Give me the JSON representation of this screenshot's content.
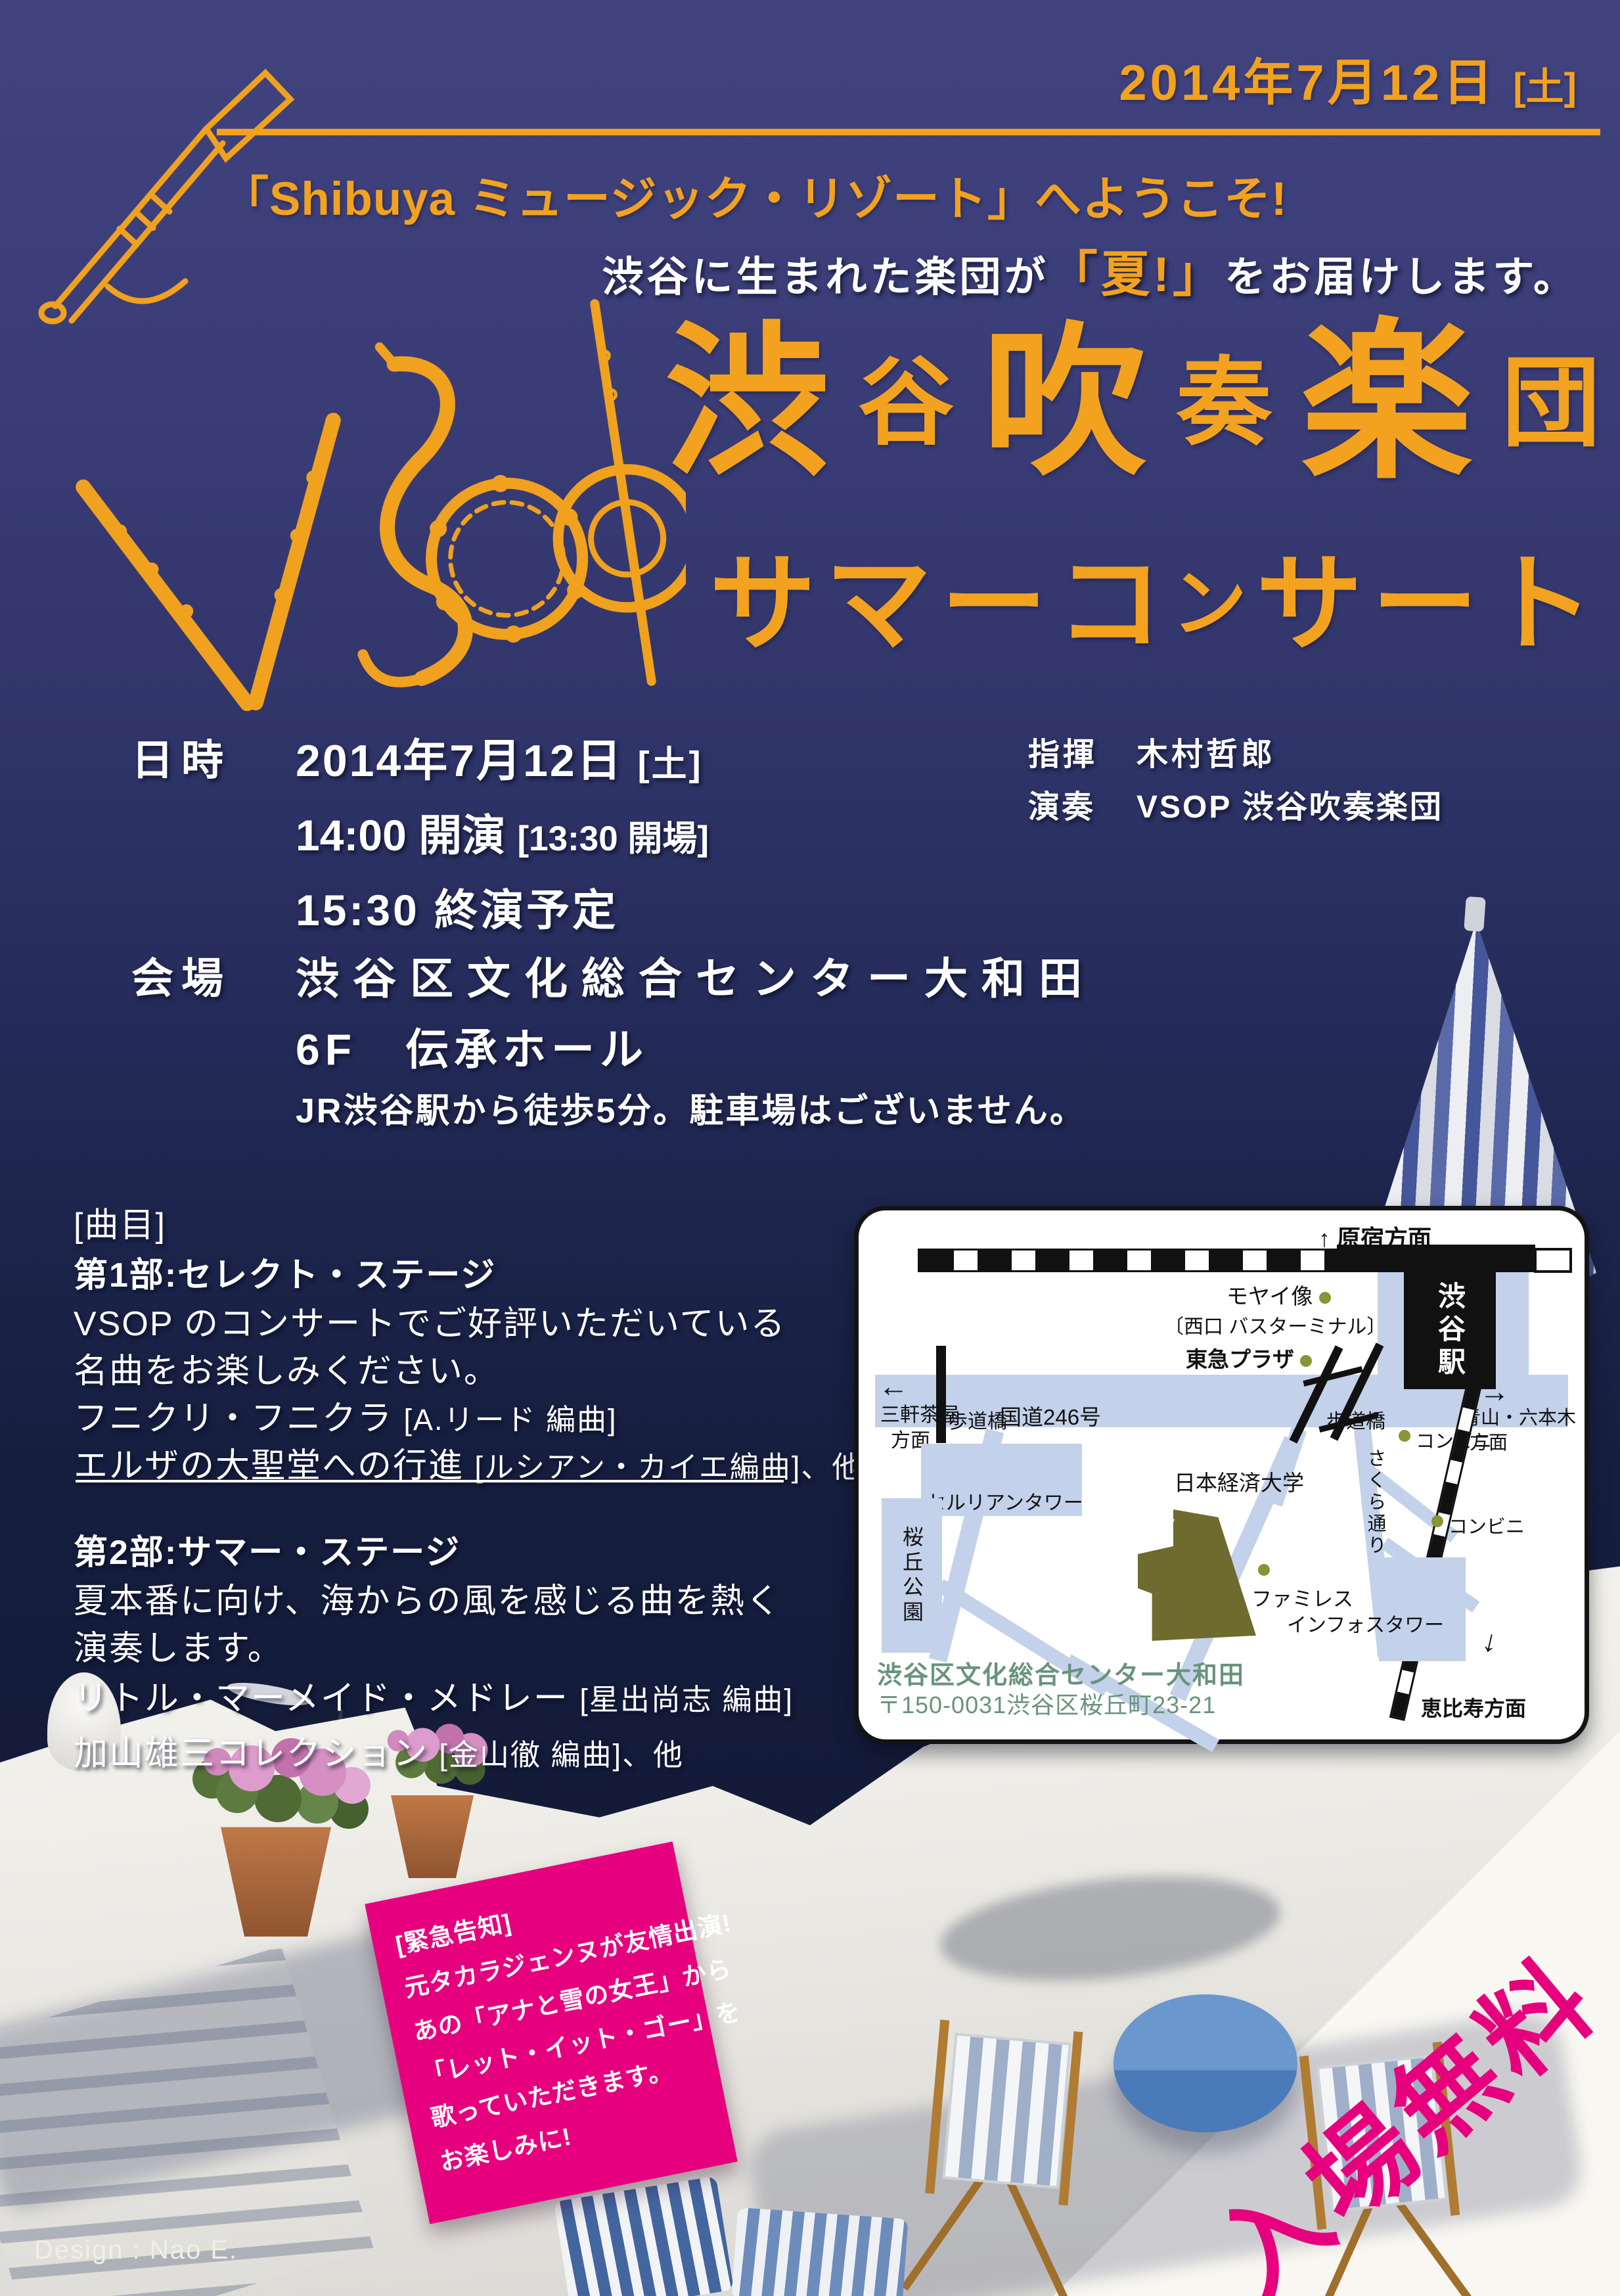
{
  "colors": {
    "navy": "#3c3f7e",
    "orange": "#f2a21f",
    "pink": "#e6007d",
    "map_road": "#c3d1ea",
    "venue_olive": "#6f6b2f",
    "caption_green": "#69937c"
  },
  "icons": {
    "arrow_up": "↑",
    "arrow_down": "↓",
    "arrow_left": "←",
    "arrow_right": "→"
  },
  "header": {
    "date": "2014年7月12日",
    "weekday": "[土]",
    "welcome": "「Shibuya ミュージック・リゾート」へようこそ!",
    "tagline_pre": "渋谷に生まれた楽団が",
    "tagline_highlight": "「夏!」",
    "tagline_post": "をお届けします。"
  },
  "title": {
    "line1_chars": [
      "渋",
      "谷",
      "吹",
      "奏",
      "楽",
      "団"
    ],
    "line2_chars": [
      "サ",
      "マ",
      "ー",
      "コ",
      "ン",
      "サ",
      "ー",
      "ト"
    ]
  },
  "details": {
    "datetime_label": "日時",
    "date": "2014年7月12日",
    "weekday": "[土]",
    "start": "14:00 開演",
    "open": "[13:30 開場]",
    "end": "15:30 終演予定",
    "conductor_label": "指揮",
    "conductor": "木村哲郎",
    "performer_label": "演奏",
    "performer": "VSOP 渋谷吹奏楽団",
    "venue_label": "会場",
    "venue": "渋谷区文化総合センター大和田",
    "floor": "6F　伝承ホール",
    "access": "JR渋谷駅から徒歩5分。駐車場はございません。"
  },
  "program": {
    "heading": "[曲目]",
    "part1_title": "第1部:セレクト・ステージ",
    "part1_desc1": "VSOP のコンサートでご好評いただいている",
    "part1_desc2": "名曲をお楽しみください。",
    "part1_piece1_name": "フニクリ・フニクラ",
    "part1_piece1_arr": "[A.リード 編曲]",
    "part1_piece2_name": "エルザの大聖堂への行進",
    "part1_piece2_arr": "[ルシアン・カイエ編曲]、他",
    "part2_title": "第2部:サマー・ステージ",
    "part2_desc1": "夏本番に向け、海からの風を感じる曲を熱く",
    "part2_desc2": "演奏します。",
    "part2_piece1_name": "リトル・マーメイド・メドレー",
    "part2_piece1_arr": "[星出尚志 編曲]",
    "part2_piece2_name": "加山雄三コレクション",
    "part2_piece2_arr": "[金山徹 編曲]、他"
  },
  "map": {
    "harajuku": "原宿方面",
    "station": "渋谷駅",
    "moyai": "モヤイ像",
    "west_exit": "〔西口 バスターミナル〕",
    "tokyu_plaza": "東急プラザ",
    "sangenjaya1": "三軒茶屋",
    "sangenjaya2": "方面",
    "hodokyo1": "歩道橋",
    "route246": "国道246号",
    "hodokyo2": "歩道橋",
    "aoyama1": "青山・六本木",
    "aoyama2": "方面",
    "cerulean": "セルリアンタワー",
    "sakuragaoka_park": "桜丘公園",
    "nihon_keizai_univ": "日本経済大学",
    "sakura_dori": "さくら通り",
    "conbini1": "コンビニ",
    "conbini2": "コンビニ",
    "famiresu": "ファミレス",
    "info_tower": "インフォスタワー",
    "ebisu": "恵比寿方面",
    "caption_name": "渋谷区文化総合センター大和田",
    "caption_address": "〒150-0031渋谷区桜丘町23-21"
  },
  "announcement": {
    "line1": "[緊急告知]",
    "line2": "元タカラジェンヌが友情出演!",
    "line3": "あの「アナと雪の女王」から",
    "line4": "「レット・イット・ゴー」を",
    "line5": "歌っていただきます。",
    "line6": "お楽しみに!"
  },
  "admission": {
    "free_text": "入場無料"
  },
  "credit": {
    "design": "Design : Nao E."
  }
}
